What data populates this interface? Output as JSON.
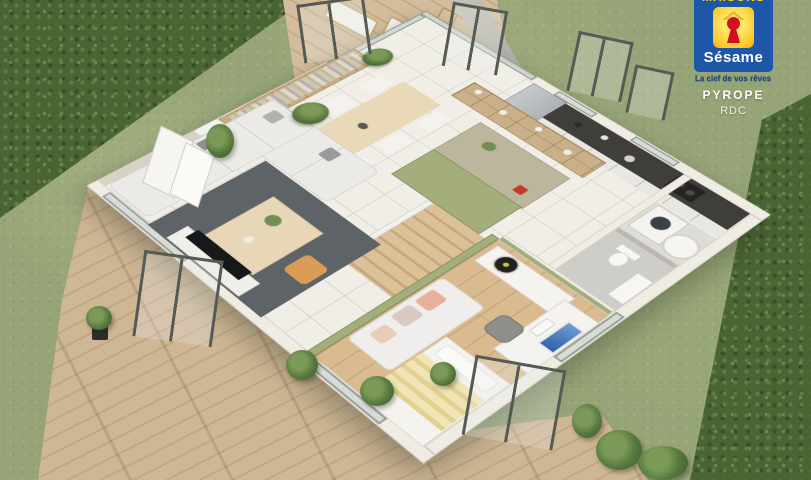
{
  "branding": {
    "logo_top_text": "MAISONS",
    "logo_name": "Sésame",
    "tagline": "La clef de vos rêves",
    "project_name": "PYROPE",
    "floor_label": "RDC",
    "colors": {
      "logo_blue": "#1e56a8",
      "logo_yellow": "#fcc92c",
      "keyhole_red": "#d40f20",
      "tagline_blue": "#16407e",
      "text_white": "#ffffff"
    }
  },
  "scene": {
    "type": "3d-floor-plan-render",
    "floor_shown": "RDC",
    "rooms": [
      "terrace-deck",
      "living-room",
      "dining-area",
      "kitchen",
      "kitchen-island",
      "staircase",
      "utility-room",
      "wc-bathroom",
      "bedroom-office",
      "garden",
      "wood-deck"
    ],
    "palette": {
      "grass": "#97a477",
      "hedge": "#4a6434",
      "deck_wood": "#cfb695",
      "tile_floor": "#f0eee7",
      "accent_wall_green": "#a3ae7c",
      "rug_gray": "#5d6366",
      "sofa_white": "#eceae6",
      "pouf_orange": "#da9c57",
      "bedroom_wood": "#dabb90",
      "kitchen_counter_dark": "#403e3a",
      "stairs_wood": "#d0b288"
    }
  }
}
